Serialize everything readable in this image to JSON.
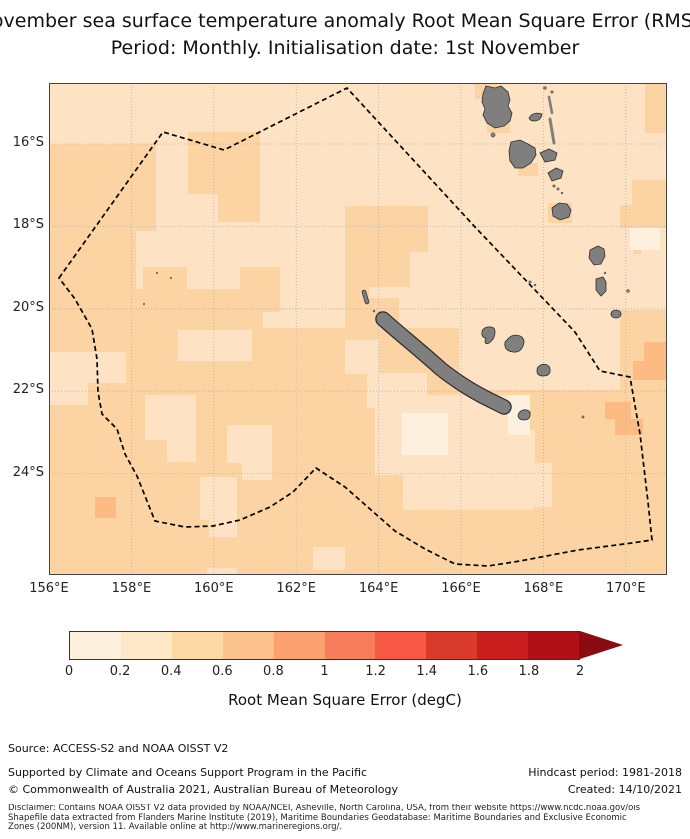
{
  "title": {
    "line1": "November sea surface temperature anomaly Root Mean Square Error (RMSE)",
    "line2": "Period: Monthly. Initialisation date: 1st November"
  },
  "map": {
    "lat_labels": [
      "16°S",
      "18°S",
      "20°S",
      "22°S",
      "24°S"
    ],
    "lon_labels": [
      "156°E",
      "158°E",
      "160°E",
      "162°E",
      "164°E",
      "166°E",
      "168°E",
      "170°E"
    ]
  },
  "colorbar": {
    "label": "Root Mean Square Error (degC)",
    "ticks": [
      "0",
      "0.2",
      "0.4",
      "0.6",
      "0.8",
      "1",
      "1.2",
      "1.4",
      "1.6",
      "1.8",
      "2"
    ],
    "colors": [
      "#fdf1de",
      "#fde7c6",
      "#fcd8a4",
      "#fbc28b",
      "#fba26e",
      "#f87d5a",
      "#f75844",
      "#d93b2b",
      "#c91d1e",
      "#b01016"
    ],
    "arrow_color": "#8a0b12"
  },
  "footer": {
    "source": "Source: ACCESS-S2 and NOAA OISST V2",
    "supported": "Supported by Climate and Oceans Support Program in the Pacific",
    "copyright": "© Commonwealth of Australia 2021, Australian Bureau of Meteorology",
    "hindcast": "Hindcast period: 1981-2018",
    "created": "Created: 14/10/2021",
    "disclaimer_line1": "Disclaimer: Contains NOAA OISST V2 data provided by NOAA/NCEI, Asheville, North Carolina, USA, from their website https://www.ncdc.noaa.gov/ois",
    "disclaimer_line2": "Shapefile data extracted from Flanders Marine Institute (2019), Maritime Boundaries Geodatabase: Maritime Boundaries and Exclusive Economic",
    "disclaimer_line3": "Zones (200NM), version 11. Available online at http://www.marineregions.org/."
  },
  "chart_data": {
    "type": "heatmap",
    "title": "November sea surface temperature anomaly Root Mean Square Error (RMSE)",
    "subtitle": "Period: Monthly. Initialisation date: 1st November",
    "x_axis_ticks": [
      "156°E",
      "158°E",
      "160°E",
      "162°E",
      "164°E",
      "166°E",
      "168°E",
      "170°E"
    ],
    "y_axis_ticks": [
      "16°S",
      "18°S",
      "20°S",
      "22°S",
      "24°S"
    ],
    "colorbar_label": "Root Mean Square Error (degC)",
    "colorbar_ticks": [
      0,
      0.2,
      0.4,
      0.6,
      0.8,
      1,
      1.2,
      1.4,
      1.6,
      1.8,
      2
    ],
    "colorbar_extend": "max",
    "value_range_degC": [
      0,
      2
    ],
    "field_summary": "RMSE mostly 0.2-0.6 degC across the region; lighter (0-0.4) north-east and around southern New Caledonia; 0.4-0.6 over the south-west sector; isolated 0.6-0.8 cells near 157.5E/25S and 169.5-171E/21-23S",
    "overlays": "Dashed line: New Caledonia EEZ boundary; grey shapes: New Caledonia, Loyalty Islands and Vanuatu islands"
  },
  "map_render": {
    "base": "c1",
    "palette": {
      "c0": "#fdf0de",
      "c1": "#fde3c4",
      "c2": "#fcd3a2",
      "c3": "#fbbb83"
    },
    "island_color": "#7f7f7f",
    "island_stroke": "#2e2e2e",
    "grid_color": "#b0b0b0",
    "frame_color": "#444444",
    "eez_color": "#000000",
    "grid": {
      "lon_x": [
        82.4,
        164.8,
        247.2,
        329.6,
        412,
        494.4,
        576.8
      ],
      "lat_y": [
        61,
        143.4,
        225.8,
        308.2,
        390.6
      ]
    },
    "patches": [
      [
        0,
        61,
        107,
        87,
        "c2"
      ],
      [
        0,
        148,
        87,
        125,
        "c2"
      ],
      [
        139,
        49,
        72,
        62,
        "c2"
      ],
      [
        169,
        111,
        42,
        28,
        "c2"
      ],
      [
        94,
        184,
        44,
        22,
        "c2"
      ],
      [
        191,
        184,
        40,
        45,
        "c2"
      ],
      [
        296,
        123,
        83,
        46,
        "c2"
      ],
      [
        316,
        169,
        45,
        35,
        "c2"
      ],
      [
        296,
        169,
        24,
        76,
        "c2"
      ],
      [
        320,
        215,
        30,
        30,
        "c2"
      ],
      [
        426,
        1,
        22,
        15,
        "c2"
      ],
      [
        438,
        35,
        23,
        15,
        "c2"
      ],
      [
        469,
        80,
        20,
        13,
        "c2"
      ],
      [
        499,
        120,
        24,
        20,
        "c2"
      ],
      [
        584,
        153,
        8,
        18,
        "c2"
      ],
      [
        596,
        0,
        22,
        50,
        "c2"
      ],
      [
        583,
        97,
        35,
        25,
        "c2"
      ],
      [
        571,
        122,
        47,
        23,
        "c2"
      ],
      [
        0,
        206,
        214,
        286,
        "c2"
      ],
      [
        210,
        245,
        200,
        247,
        "c2"
      ],
      [
        410,
        307,
        40,
        185,
        "c2"
      ],
      [
        450,
        307,
        168,
        185,
        "c2"
      ],
      [
        571,
        227,
        47,
        80,
        "c2"
      ],
      [
        0,
        269,
        77,
        31,
        "c1"
      ],
      [
        0,
        269,
        39,
        53,
        "c1"
      ],
      [
        96,
        312,
        51,
        45,
        "c1"
      ],
      [
        118,
        357,
        29,
        22,
        "c1"
      ],
      [
        129,
        247,
        74,
        31,
        "c1"
      ],
      [
        178,
        342,
        45,
        38,
        "c1"
      ],
      [
        193,
        380,
        30,
        17,
        "c1"
      ],
      [
        151,
        394,
        37,
        43,
        "c1"
      ],
      [
        160,
        437,
        28,
        17,
        "c1"
      ],
      [
        296,
        257,
        34,
        34,
        "c1"
      ],
      [
        318,
        290,
        60,
        35,
        "c1"
      ],
      [
        326,
        312,
        140,
        80,
        "c1"
      ],
      [
        409,
        347,
        77,
        45,
        "c1"
      ],
      [
        354,
        392,
        130,
        35,
        "c1"
      ],
      [
        479,
        380,
        24,
        44,
        "c1"
      ],
      [
        264,
        464,
        32,
        23,
        "c1"
      ],
      [
        158,
        485,
        30,
        7,
        "c1"
      ],
      [
        581,
        145,
        30,
        22,
        "c0"
      ],
      [
        353,
        330,
        46,
        42,
        "c0"
      ],
      [
        459,
        312,
        22,
        40,
        "c0"
      ],
      [
        46,
        414,
        21,
        21,
        "c3"
      ],
      [
        595,
        259,
        23,
        19,
        "c3"
      ],
      [
        584,
        278,
        34,
        19,
        "c3"
      ],
      [
        556,
        319,
        26,
        17,
        "c3"
      ],
      [
        566,
        336,
        28,
        16,
        "c3"
      ]
    ],
    "islands": [
      {
        "name": "espiritu-santo",
        "d": "M437,3 l9,2 6,-2 7,6 2,8 -2,6 4,7 -2,8 -6,5 -9,2 -8,-5 -4,-8 2,-6 -3,-7 1,-8 z"
      },
      {
        "name": "malakula",
        "d": "M462,59 l9,-2 8,4 7,4 1,7 -5,8 -8,5 -8,0 -5,-7 -1,-10 z"
      },
      {
        "name": "ambae",
        "d": "M480,35 q4,-7 13,-4 q-1,7 -8,7 q-4,0 -5,-3 z"
      },
      {
        "name": "ambrym",
        "d": "M491,70 l9,-4 8,4 -2,7 -10,2 -5,-9 z"
      },
      {
        "name": "epi",
        "d": "M499,90 l8,-5 7,3 -2,7 -9,3 -4,-8 z"
      },
      {
        "name": "efate",
        "d": "M503,125 l7,-5 8,1 4,6 -2,7 -9,3 -7,-4 -1,-8 z"
      },
      {
        "name": "erromango",
        "d": "M541,167 l8,-4 6,3 1,7 -4,8 -7,1 -5,-7 1,-8 z"
      },
      {
        "name": "tanna",
        "d": "M547,196 l7,-2 3,5 0,9 -5,5 -5,-6 0,-11 z"
      },
      {
        "name": "aneityum",
        "d": "M562,231 a5,4 0 1 0 10,0 a5,4 0 1 0 -10,0 z"
      },
      {
        "name": "ouvea",
        "d": "M433,252 q-1,-7 6,-8 q7,-1 7,5 q0,7 -6,11 q-4,2 -4,-2 l1,-3 q-3,0 -4,-3 z"
      },
      {
        "name": "lifou",
        "d": "M458,257 q5,-7 13,-4 q6,3 3,10 q-3,7 -10,6 q-7,-1 -8,-6 q-1,-4 2,-6 z"
      },
      {
        "name": "mare",
        "d": "M489,284 q4,-4 9,-2 q4,2 3,7 q-1,4 -7,4 q-6,0 -6,-5 q0,-3 1,-4 z"
      },
      {
        "name": "ile-des-pins",
        "d": "M470,330 q3,-4 8,-3 q4,1 3,6 q-1,4 -6,4 q-5,0 -6,-4 q0,-2 1,-3 z"
      }
    ],
    "strokes": [
      {
        "name": "grande-terre-outline",
        "d": "M334,236 C352,252 372,268 392,286 C412,302 432,313 447,320 l8,4",
        "c": "#2e2e2e",
        "w": 15.5
      },
      {
        "name": "grande-terre",
        "d": "M334,236 C352,252 372,268 392,286 C412,302 432,313 447,320 l8,4",
        "c": "#7f7f7f",
        "w": 13
      },
      {
        "name": "belep-outline",
        "d": "M315,209 L318,219",
        "c": "#2e2e2e",
        "w": 4.5
      },
      {
        "name": "belep",
        "d": "M315,209 L318,219",
        "c": "#7f7f7f",
        "w": 3
      },
      {
        "name": "maewo",
        "d": "M500,14 L503,30",
        "c": "#7f7f7f",
        "w": 2.6
      },
      {
        "name": "pentecost",
        "d": "M501,36 L505,60",
        "c": "#7f7f7f",
        "w": 3
      }
    ],
    "dots": [
      [
        325,
        228,
        1
      ],
      [
        329,
        231,
        1
      ],
      [
        444,
        52,
        2.2
      ],
      [
        505,
        103,
        1.3
      ],
      [
        509,
        106,
        1.2
      ],
      [
        513,
        110,
        1
      ],
      [
        556,
        190,
        1
      ],
      [
        579,
        208,
        1.5
      ],
      [
        534,
        334,
        1.2
      ],
      [
        496,
        5,
        1.5
      ],
      [
        503,
        9,
        1.3
      ],
      [
        481,
        199,
        1.2
      ],
      [
        486,
        202,
        1
      ],
      [
        108,
        190,
        0.8
      ],
      [
        122,
        195,
        0.8
      ],
      [
        95,
        221,
        0.8
      ]
    ],
    "eez": "M10,195 L114,49 L175,67 L298,5 L426,144 L526,249 L551,288 L581,294 L591,351 L599,419 L603,457 L583,460 L529,467 L471,478 L439,483 L406,481 L376,466 L346,448 L321,426 L296,404 L267,385 L244,409 L221,424 L191,437 L164,443 L136,444 L106,438 L96,413 L88,393 L76,371 L68,346 L53,331 L49,309 L48,276 L43,246 L26,216 Z"
  }
}
